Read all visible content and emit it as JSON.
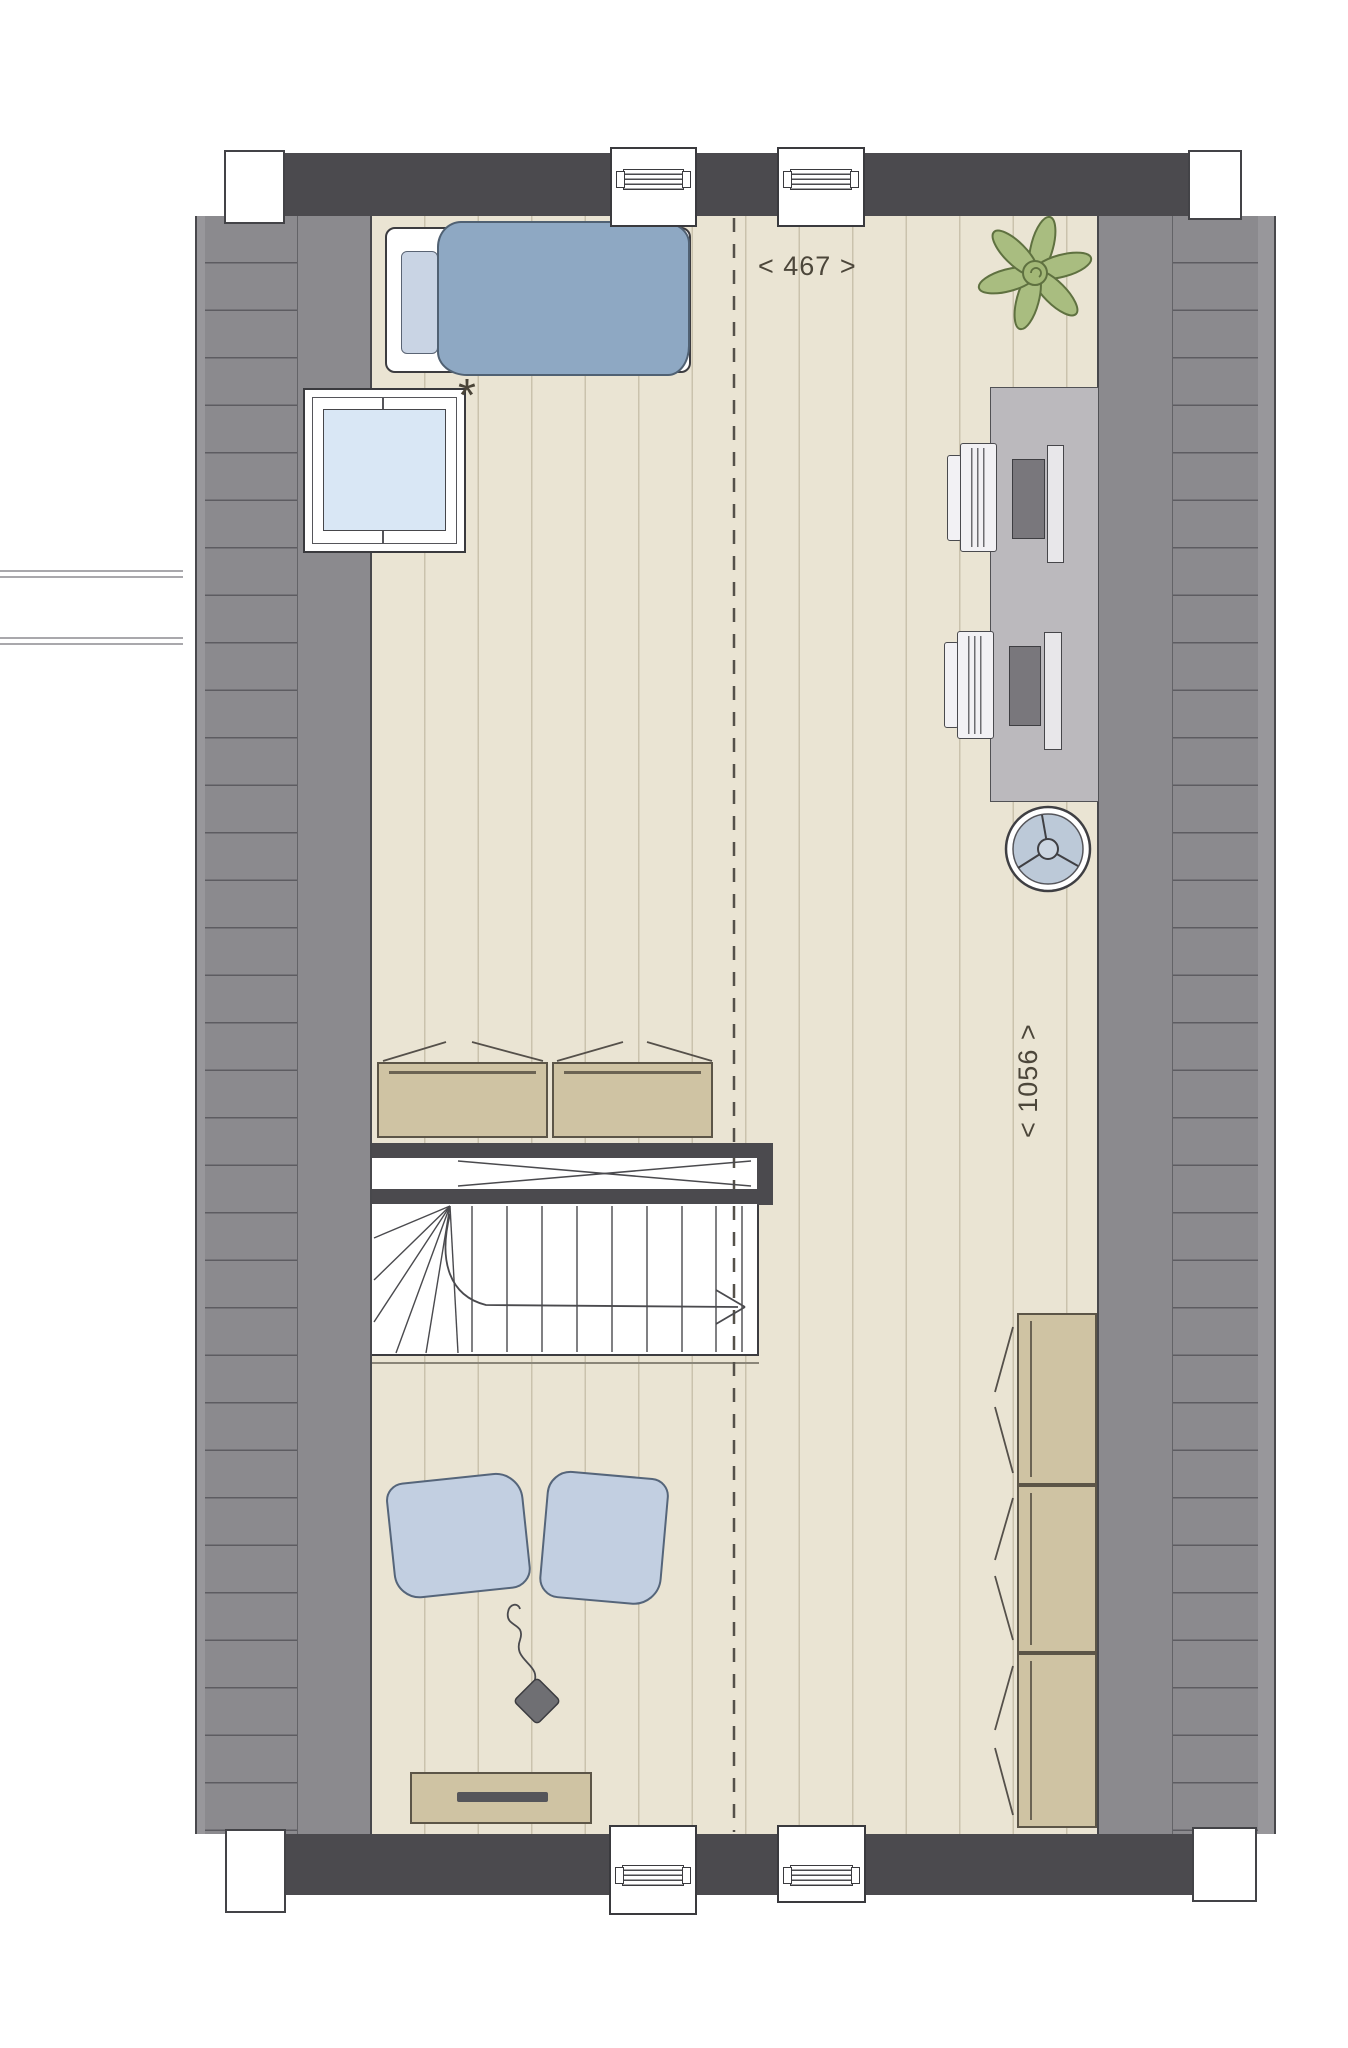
{
  "document": {
    "type": "architectural floor plan",
    "floor": "attic storey between two sloped roof planes",
    "style": "hand-drawn colored plan view, top-down"
  },
  "labels": {
    "width_dimension": "< 467 >",
    "length_dimension": "< 1056 >",
    "window_footnote": "*"
  },
  "palette": {
    "wall_dark": "#4b4a4e",
    "roof_gray": "#8b8a8e",
    "roof_edge_gray": "#98979b",
    "floor_cream": "#eae4d3",
    "furniture_tan": "#cfc3a3",
    "textile_blue": "#8ea8c3",
    "cushion_blue": "#c2cfe1",
    "glass_blue": "#d9e7f5",
    "desk_gray": "#bbb9bd",
    "plant_green": "#a9bd80",
    "line_dark": "#3c3c40",
    "text_color": "#4c463a"
  },
  "fixtures": [
    {
      "name": "top-facade-wall"
    },
    {
      "name": "bottom-facade-wall"
    },
    {
      "name": "four-chimney-blocks"
    },
    {
      "name": "two-roof-windows-top-wall"
    },
    {
      "name": "two-roof-windows-bottom-wall"
    },
    {
      "name": "skylight-window-with-footnote-asterisk"
    },
    {
      "name": "left-sloped-roof-plane"
    },
    {
      "name": "right-sloped-roof-plane"
    },
    {
      "name": "ridge-dashed-line"
    },
    {
      "name": "staircase-with-winders-and-void"
    }
  ],
  "furniture": [
    {
      "name": "single-bed-with-blue-duvet-and-pillow"
    },
    {
      "name": "potted-plant"
    },
    {
      "name": "desk-with-two-workstations"
    },
    {
      "name": "two-desk-chairs"
    },
    {
      "name": "two-laptops"
    },
    {
      "name": "two-monitors"
    },
    {
      "name": "floor-fan"
    },
    {
      "name": "two-low-cabinets-at-stair-void"
    },
    {
      "name": "three-tall-storage-cabinets-right"
    },
    {
      "name": "two-floor-cushions"
    },
    {
      "name": "speaker-with-cord"
    },
    {
      "name": "sideboard-with-handle"
    }
  ]
}
